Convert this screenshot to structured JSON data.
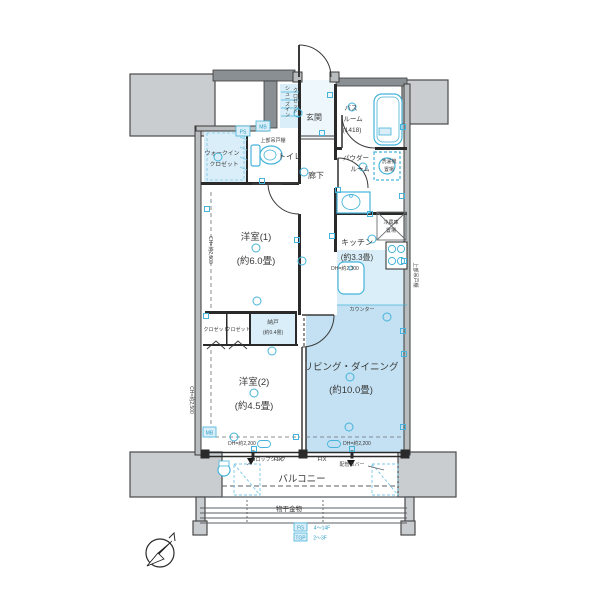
{
  "rooms": {
    "bedroom1": {
      "name": "洋室(1)",
      "size": "(約6.0畳)"
    },
    "bedroom2": {
      "name": "洋室(2)",
      "size": "(約4.5畳)"
    },
    "living": {
      "name": "リビング・ダイニング",
      "size": "(約10.0畳)"
    },
    "kitchen": {
      "name": "キッチン",
      "size": "(約3.3畳)"
    },
    "bath": {
      "line1": "バス",
      "line2": "ルーム",
      "line3": "(1418)"
    },
    "powder": {
      "line1": "パウダー",
      "line2": "ルーム"
    },
    "entrance": "玄関",
    "toilet": "トイレ",
    "hallway": "廊下",
    "wic": {
      "line1": "ウォークイン",
      "line2": "クロゼット"
    },
    "sic": {
      "line1": "シューズイン",
      "line2": "クロゼット"
    },
    "storage": {
      "name": "納戸",
      "size": "(約0.4畳)"
    },
    "closet1": "クロゼット",
    "closet2": "クロゼット",
    "balcony": "バルコニー"
  },
  "annotations": {
    "fridge_line1": "冷蔵庫",
    "fridge_line2": "置場",
    "washer_line1": "洗濯機",
    "washer_line2": "置場",
    "counter": "カウンター",
    "upper_cabinet_toilet": "上部吊戸棚",
    "upper_cabinet_kitchen": "上部吊戸棚",
    "laundry_hardware": "物干金物",
    "fix1": "FIX",
    "fix2": "FIX",
    "pipe_cover": "配管カバー",
    "slop_sink": "スロップシンク",
    "dh_left": "DH=約2,200",
    "dh_right": "DH=約2,200",
    "dh_kitchen": "DH=約2,300",
    "ch_bedroom1": "CH=約2,500",
    "ch_bedroom2": "CH=約2,500",
    "ps": "PS",
    "mb_top": "MB",
    "mb_bottom": "MB",
    "fg_tag": "FG",
    "fg_range": "4〜14F",
    "tgp_tag": "TGP",
    "tgp_range": "2〜3F"
  },
  "colors": {
    "highlight_room": "#c3e1f2",
    "highlight_light": "#d9eef8",
    "fixture_stroke": "#45b3da",
    "wall": "#2a2a2a",
    "gray_block": "#c9cdd0"
  },
  "fixture_symbols": {
    "circles": [
      [
        298,
        113
      ],
      [
        304,
        172
      ],
      [
        256,
        248
      ],
      [
        254,
        393
      ],
      [
        350,
        377
      ],
      [
        372,
        239
      ],
      [
        352,
        107
      ],
      [
        363,
        167
      ],
      [
        218,
        157
      ],
      [
        257,
        301
      ],
      [
        349,
        427
      ],
      [
        302,
        261
      ],
      [
        234,
        437
      ],
      [
        387,
        317
      ],
      [
        272,
        351
      ]
    ],
    "squares": [
      [
        330,
        95
      ],
      [
        403,
        127
      ],
      [
        338,
        190
      ],
      [
        402,
        196
      ],
      [
        332,
        236
      ],
      [
        404,
        261
      ],
      [
        297,
        240
      ],
      [
        206,
        316
      ],
      [
        296,
        437
      ],
      [
        403,
        331
      ],
      [
        254,
        449
      ],
      [
        352,
        449
      ],
      [
        403,
        427
      ],
      [
        207,
        209
      ],
      [
        262,
        181
      ],
      [
        322,
        133
      ],
      [
        404,
        354
      ],
      [
        370,
        214
      ]
    ],
    "pills": [
      [
        264,
        444
      ],
      [
        334,
        444
      ]
    ]
  }
}
